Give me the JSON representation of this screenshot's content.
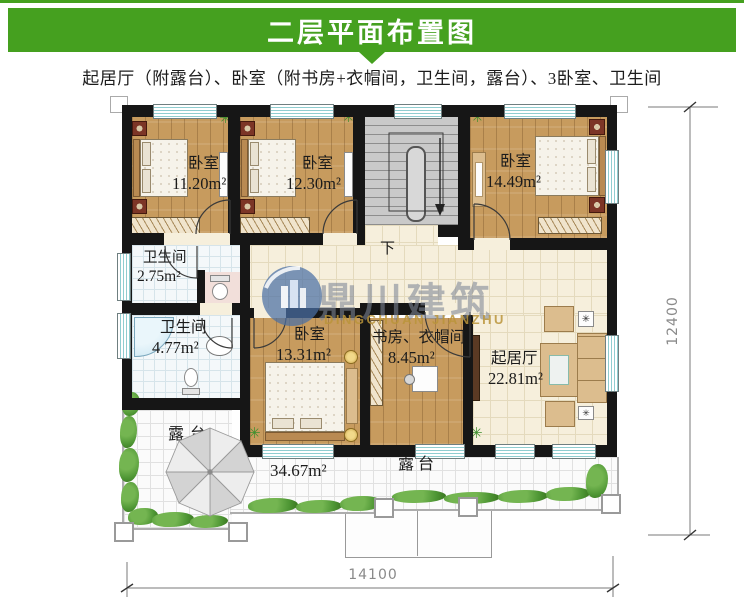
{
  "banner": {
    "title": "二层平面布置图",
    "color": "#45a01f"
  },
  "subtitle": "起居厅（附露台）、卧室（附书房+衣帽间，卫生间，露台）、3卧室、卫生间",
  "watermark": {
    "cn": "鼎川建筑",
    "en": "DINGCHUAN JIANZHU"
  },
  "rooms": {
    "bedroom1": {
      "name": "卧室",
      "area": "11.20m²"
    },
    "bedroom2": {
      "name": "卧室",
      "area": "12.30m²"
    },
    "bedroom3": {
      "name": "卧室",
      "area": "14.49m²"
    },
    "bath1": {
      "name": "卫生间",
      "area": "2.75m²"
    },
    "bath2": {
      "name": "卫生间",
      "area": "4.77m²"
    },
    "bedroom4": {
      "name": "卧室",
      "area": "13.31m²"
    },
    "study": {
      "name": "书房、衣帽间",
      "area": "8.45m²"
    },
    "living": {
      "name": "起居厅",
      "area": "22.81m²"
    },
    "terrace_left": {
      "name": "露台",
      "area": "34.67m²"
    },
    "terrace_bottom": {
      "name": "露台"
    }
  },
  "stairs": {
    "down": "下"
  },
  "dimensions": {
    "width": "14100",
    "height": "12400"
  },
  "icons": {
    "plant": "✳",
    "planter": "✳"
  },
  "colors": {
    "banner_green": "#45a01f",
    "wall": "#161616",
    "wood_floor": "#c79b5e",
    "cream_tile": "#f6efdc",
    "bath_tile": "#f4f8fa",
    "terrace_tile": "#fbfbfb",
    "greenery": "#4e9634",
    "window_stripe": "#8fcdd0",
    "watermark_blue": "#4a6fa5",
    "watermark_gold": "#ba9440"
  }
}
